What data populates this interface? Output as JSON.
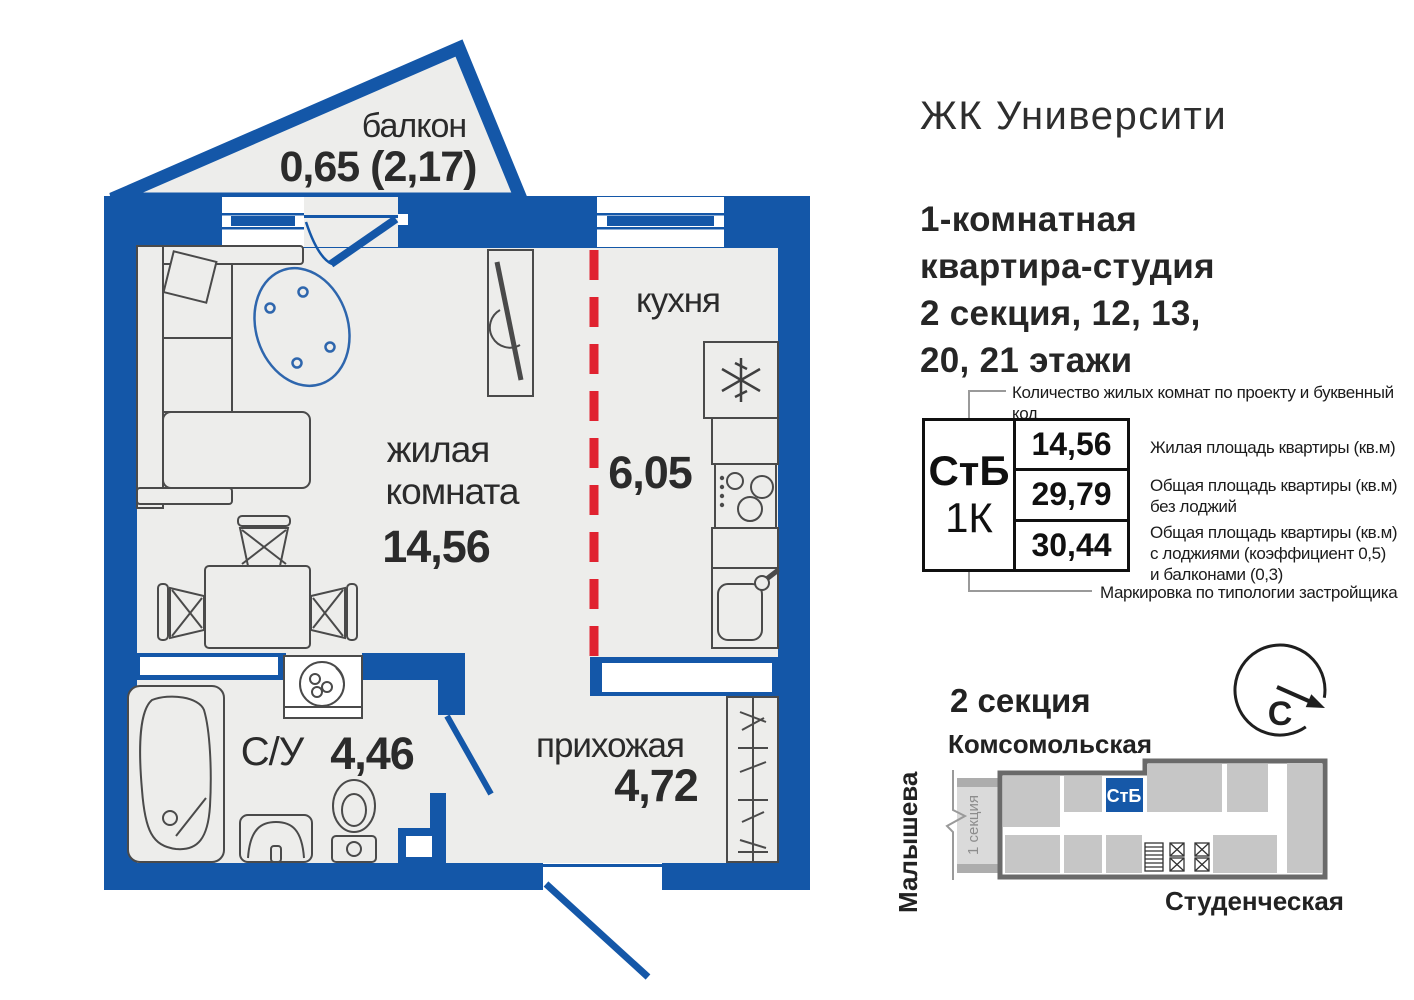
{
  "header": {
    "project_title": "ЖК Университи",
    "subtitle": "1-комнатная\nквартира-студия\n2 секция, 12, 13,\n20, 21 этажи"
  },
  "floorplan": {
    "balcony": {
      "name": "балкон",
      "area": "0,65 (2,17)"
    },
    "kitchen": {
      "name": "кухня",
      "area": "6,05"
    },
    "living": {
      "name_line1": "жилая",
      "name_line2": "комната",
      "area": "14,56"
    },
    "bathroom": {
      "name": "С/У",
      "area": "4,46"
    },
    "hallway": {
      "name": "прихожая",
      "area": "4,72"
    }
  },
  "info_table": {
    "top_note": "Количество жилых комнат по проекту и буквенный код",
    "bottom_note": "Маркировка по типологии застройщика",
    "type_code": "СтБ",
    "rooms_code": "1К",
    "rows": [
      {
        "value": "14,56",
        "note": "Жилая площадь квартиры (кв.м)"
      },
      {
        "value": "29,79",
        "note": "Общая площадь квартиры (кв.м)\nбез лоджий"
      },
      {
        "value": "30,44",
        "note": "Общая площадь квартиры (кв.м)\nс лоджиями (коэффициент 0,5)\nи балконами (0,3)"
      }
    ]
  },
  "section_map": {
    "title": "2 секция",
    "street_top": "Комсомольская",
    "street_left": "Малышева",
    "street_bottom": "Студенческая",
    "unit_label": "СтБ",
    "adjacent_section_label": "1 секция",
    "north_letter": "С"
  },
  "colors": {
    "wall_blue": "#1457a8",
    "accent_red": "#e02330",
    "floor_gray": "#ededeb",
    "map_block_gray": "#c6c6c6",
    "map_outline_gray": "#6a6a6a"
  }
}
